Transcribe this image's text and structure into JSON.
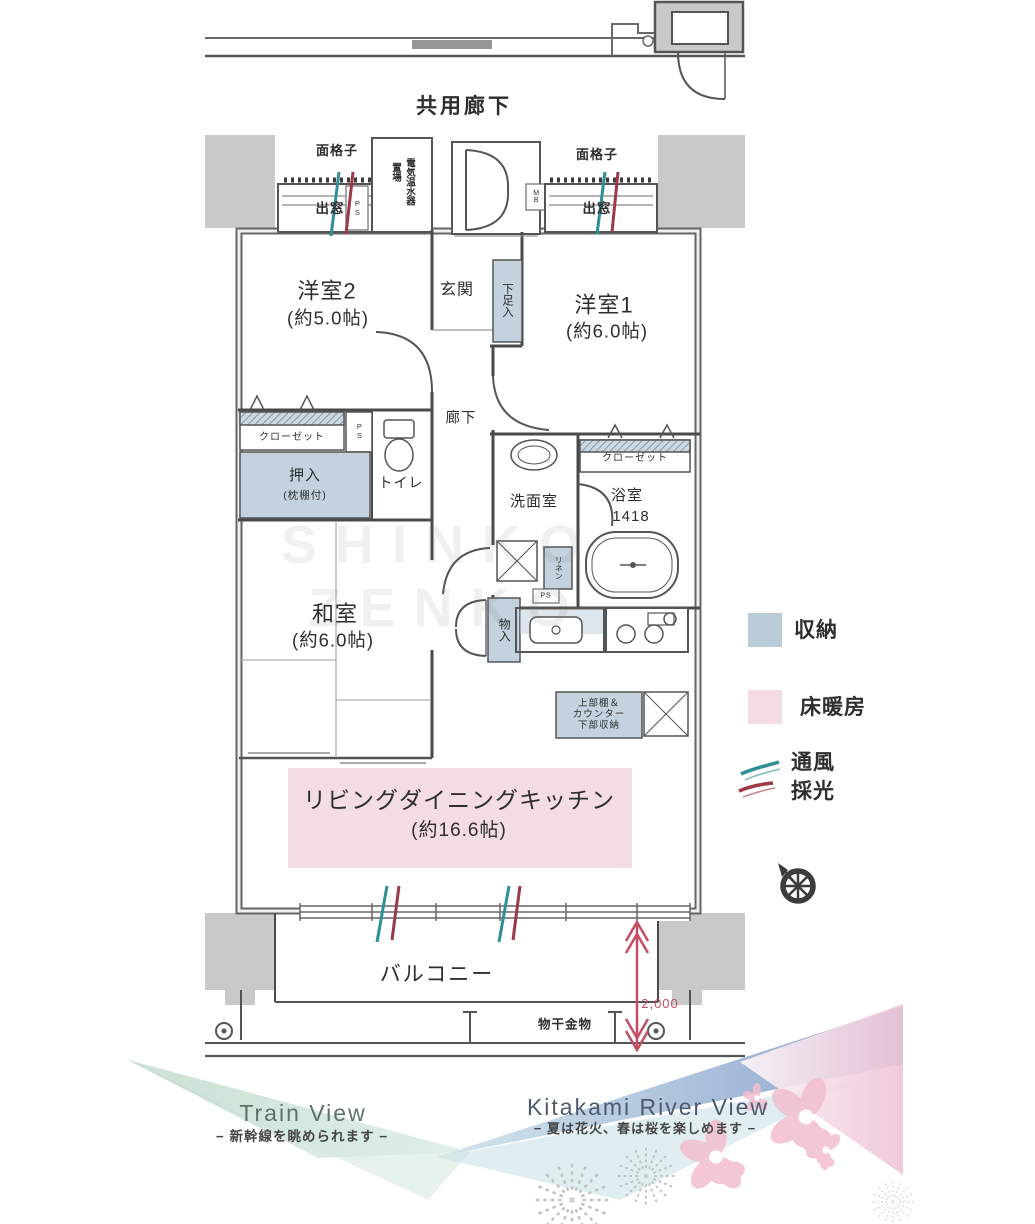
{
  "colors": {
    "c-storage": "#c3d2de",
    "c-heating": "#f3dce3",
    "c-teal": "#2e8f96",
    "c-red": "#9c3947",
    "c-dim": "#c44f63",
    "c-pillar": "#c9c9c9",
    "c-line": "#4a4a4a"
  },
  "plan": {
    "corridor_label": "共用廊下",
    "top": {
      "grille_left": "面格子",
      "grille_right": "面格子",
      "bay_left": "出窓",
      "bay_right": "出窓",
      "water_heater_line1": "電気温水器",
      "water_heater_line2": "置場",
      "ps1": "PS",
      "mb": "MB"
    },
    "rooms": {
      "western2_name": "洋室2",
      "western2_size": "(約5.0帖)",
      "western1_name": "洋室1",
      "western1_size": "(約6.0帖)",
      "japanese_name": "和室",
      "japanese_size": "(約6.0帖)",
      "ldk_name": "リビングダイニングキッチン",
      "ldk_size": "(約16.6帖)",
      "entrance": "玄関",
      "hallway": "廊下",
      "toilet": "トイレ",
      "washroom": "洗面室",
      "bathroom": "浴室",
      "bathroom_size": "1418",
      "balcony": "バルコニー"
    },
    "storage": {
      "shoe": "下足入",
      "closet_left": "クローゼット",
      "closet_right": "クローゼット",
      "oshiire": "押入",
      "oshiire_note": "(枕棚付)",
      "monoire": "物入",
      "linen": "リネン",
      "ps2": "PS",
      "ps3": "PS",
      "counter_line1": "上部棚＆",
      "counter_line2": "カウンター",
      "counter_line3": "下部収納"
    },
    "balcony_items": {
      "laundry": "物干金物",
      "dimension": "2,000"
    }
  },
  "legend": {
    "storage": "収納",
    "floor_heating": "床暖房",
    "ventilation": "通風",
    "daylight": "採光"
  },
  "views": {
    "train_title": "Train View",
    "train_subtitle": "− 新幹線を眺められます −",
    "river_title": "Kitakami River View",
    "river_subtitle": "− 夏は花火、春は桜を楽しめます −"
  },
  "watermark_line1": "SHINKO",
  "watermark_line2": "ZENKO"
}
